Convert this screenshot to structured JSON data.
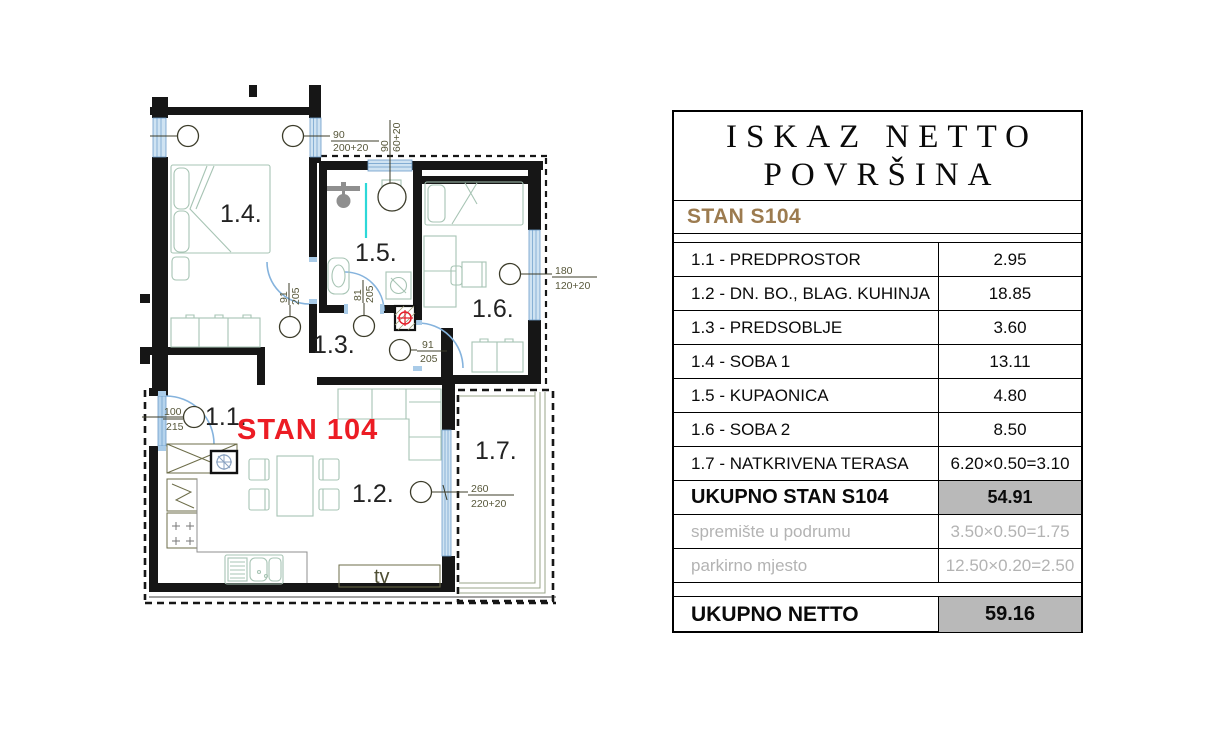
{
  "plan": {
    "apartment_label": "STAN 104",
    "tv_label": "tv",
    "room_labels": [
      "1.1.",
      "1.2.",
      "1.3.",
      "1.4.",
      "1.5.",
      "1.6.",
      "1.7."
    ],
    "dims": {
      "window_room14": {
        "w": "90",
        "h": "200+20"
      },
      "window_bath": {
        "w": "90",
        "h": "60+20"
      },
      "window_room16": {
        "w": "180",
        "h": "120+20"
      },
      "door_room14": {
        "w": "91",
        "h": "205"
      },
      "door_bath": {
        "w": "81",
        "h": "205"
      },
      "door_room16": {
        "w": "91",
        "h": "205"
      },
      "door_entry": {
        "w": "100",
        "h": "215"
      },
      "door_terrace": {
        "w": "260",
        "h": "220+20"
      }
    }
  },
  "table": {
    "title_line1": "ISKAZ NETTO",
    "title_line2": "POVRŠINA",
    "subtitle": "STAN S104",
    "rows": [
      {
        "label": "1.1 - PREDPROSTOR",
        "value": "2.95"
      },
      {
        "label": "1.2 - DN. BO., BLAG. KUHINJA",
        "value": "18.85"
      },
      {
        "label": "1.3 - PREDSOBLJE",
        "value": "3.60"
      },
      {
        "label": "1.4 - SOBA 1",
        "value": "13.11"
      },
      {
        "label": "1.5 - KUPAONICA",
        "value": "4.80"
      },
      {
        "label": "1.6 - SOBA 2",
        "value": "8.50"
      },
      {
        "label": "1.7 - NATKRIVENA TERASA",
        "value": "6.20×0.50=3.10"
      },
      {
        "label": "UKUPNO STAN S104",
        "value": "54.91"
      },
      {
        "label": "spremište u podrumu",
        "value": "3.50×0.50=1.75"
      },
      {
        "label": "parkirno mjesto",
        "value": "12.50×0.20=2.50"
      },
      {
        "label": "UKUPNO NETTO",
        "value": "59.16"
      }
    ]
  },
  "colors": {
    "accent_red": "#ec1c24",
    "subtitle_brown": "#9c7b4f",
    "total_cell_bg": "#b9b9b9",
    "muted_text": "#b3b3b3",
    "window_blue": "#cfe3f2",
    "furniture_green": "#a7c4b4"
  }
}
